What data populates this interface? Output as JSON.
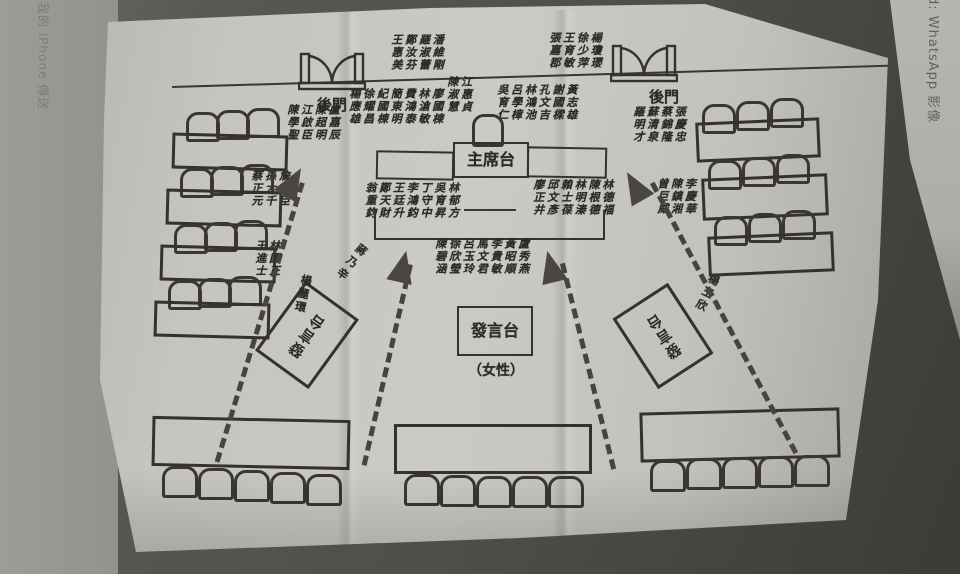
{
  "colors": {
    "ink": "#35322d",
    "paper_gray": "#c5c4be",
    "background_shadow": "#504e4a",
    "arrow": "#47443f"
  },
  "edges": {
    "left_text": "我的 iPhone 傳送",
    "right_text": "d: WhatsApp 影像"
  },
  "diagram": {
    "labels": {
      "back_door_left": "後門",
      "back_door_right": "後門",
      "chairman_platform": "主席台",
      "podium_center": "發言台",
      "podium_center_note": "（女性）",
      "podium_left": "發言台",
      "podium_right": "發言台"
    },
    "name_groups": {
      "outside_door_left": [
        "王惠美",
        "鄭汝芬",
        "羅淑蕾",
        "潘維剛"
      ],
      "outside_door_right": [
        "張嘉郡",
        "王育敏",
        "徐少萍",
        "楊瓊瓔"
      ],
      "stage_rear_left": [
        "楊應雄",
        "徐耀昌",
        "紀國棟",
        "簡東明",
        "費鴻泰",
        "林滄敏",
        "廖國棟"
      ],
      "stage_rear_center": [
        "陳淑慧",
        "江惠貞"
      ],
      "stage_rear_right": [
        "吳育仁",
        "呂學樟",
        "林鴻池",
        "孔文吉",
        "謝國樑",
        "黃志雄"
      ],
      "left_wing_top": [
        "陳學聖",
        "江啟臣",
        "陳超明",
        "盧嘉辰"
      ],
      "left_wing_mid": [
        "蔡正元",
        "孫大千",
        "詹凱臣"
      ],
      "left_wing_low": [
        "王進士",
        "林國正"
      ],
      "right_wing_top": [
        "羅明才",
        "蘇清泉",
        "蔡錦隆",
        "張慶忠"
      ],
      "right_wing_mid": [
        "曾巨威",
        "陳鎮湘",
        "李慶華"
      ],
      "stage_front_left": [
        "翁重鈞",
        "鄭天財",
        "王廷升",
        "李鴻鈞",
        "丁守中",
        "吳育昇",
        "林郁方"
      ],
      "stage_front_right": [
        "廖正井",
        "邱文彥",
        "賴士葆",
        "林明溱",
        "陳根德",
        "林德福"
      ],
      "floor_center": [
        "陳碧涵",
        "徐欣瑩",
        "呂玉玲",
        "馬文君",
        "李貴敏",
        "黃昭順",
        "盧秀燕"
      ]
    },
    "individual_names": {
      "aisle_left_upper": "蔣乃辛",
      "aisle_left_lower": "楊麗環",
      "aisle_right": "楊玉欣"
    }
  }
}
